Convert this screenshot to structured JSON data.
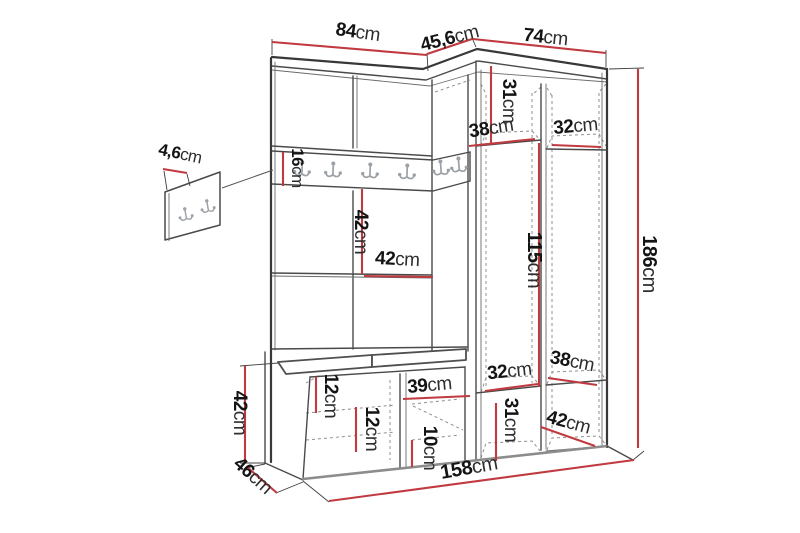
{
  "colors": {
    "dimension_red": "#c03a40",
    "outline_dark": "#383838",
    "outline_mid": "#4a4a4a",
    "dashed_gray": "#8f8f8f",
    "hook_gray": "#9ba1a6",
    "label_text": "#141414"
  },
  "icons": {
    "coat_hook": "double-prong-coat-hook"
  },
  "dims": {
    "top_left_width": {
      "v": "84",
      "u": "cm"
    },
    "top_corner_width": {
      "v": "45,6",
      "u": "cm"
    },
    "top_right_width": {
      "v": "74",
      "u": "cm"
    },
    "panel_thickness": {
      "v": "4,6",
      "u": "cm"
    },
    "upper_right_height": {
      "v": "31",
      "u": "cm"
    },
    "upper_shelf_left": {
      "v": "38",
      "u": "cm"
    },
    "upper_shelf_right": {
      "v": "32",
      "u": "cm"
    },
    "rail_height": {
      "v": "16",
      "u": "cm"
    },
    "open_height": {
      "v": "42",
      "u": "cm"
    },
    "open_width": {
      "v": "42",
      "u": "cm"
    },
    "hanging_height": {
      "v": "115",
      "u": "cm"
    },
    "total_height": {
      "v": "186",
      "u": "cm"
    },
    "lower_shelf_left": {
      "v": "32",
      "u": "cm"
    },
    "lower_shelf_right": {
      "v": "38",
      "u": "cm"
    },
    "lower_right_height": {
      "v": "31",
      "u": "cm"
    },
    "bottom_shelf_depth": {
      "v": "42",
      "u": "cm"
    },
    "bench_inner_width": {
      "v": "39",
      "u": "cm"
    },
    "bench_gap_top": {
      "v": "12",
      "u": "cm"
    },
    "bench_gap_mid": {
      "v": "12",
      "u": "cm"
    },
    "bench_gap_bottom": {
      "v": "10",
      "u": "cm"
    },
    "bench_height": {
      "v": "42",
      "u": "cm"
    },
    "bench_depth": {
      "v": "46",
      "u": "cm"
    },
    "total_width": {
      "v": "158",
      "u": "cm"
    }
  }
}
